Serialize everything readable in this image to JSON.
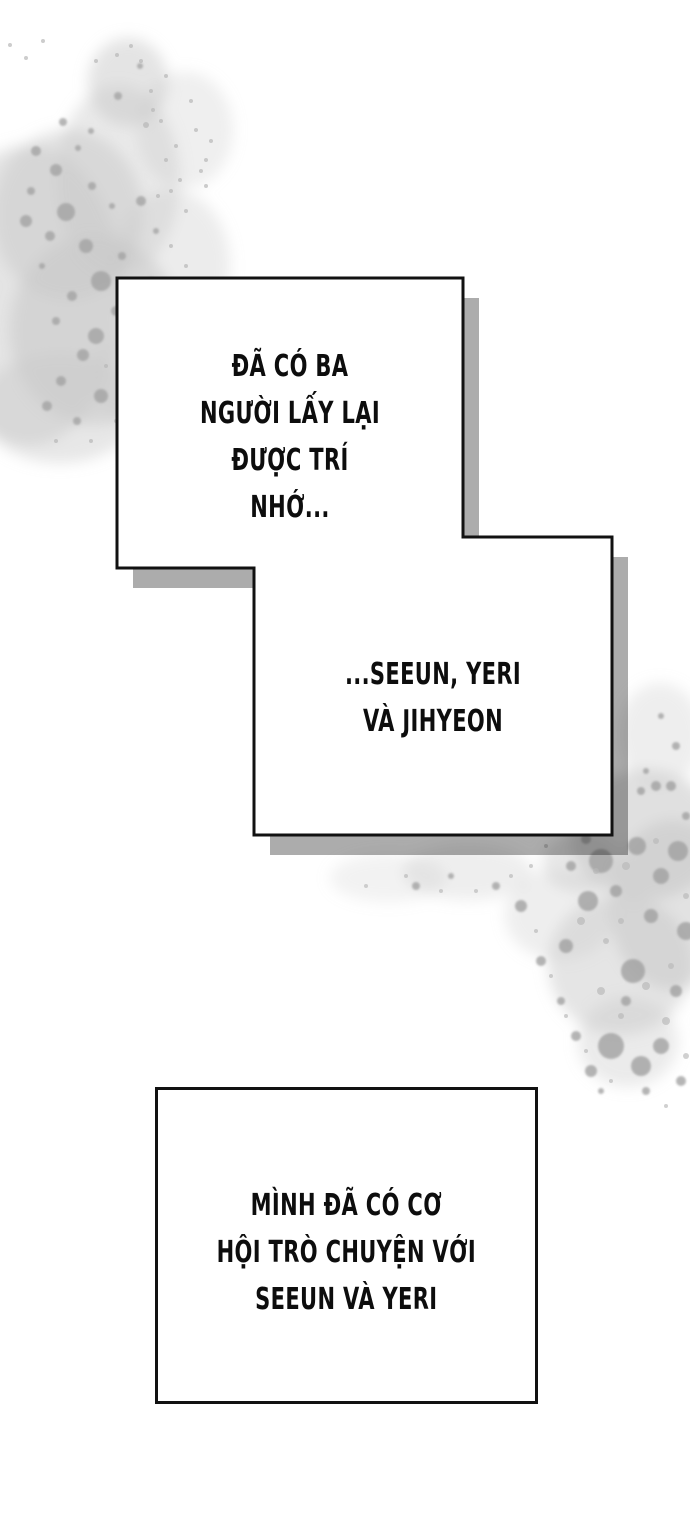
{
  "page": {
    "type": "comic-panel-page",
    "background_color": "#ffffff"
  },
  "colors": {
    "panel_border": "#111111",
    "panel_fill": "#ffffff",
    "panel_shadow": "#acacac",
    "text": "#0d0d0d",
    "watercolor_wash": "#c9c9c9",
    "watercolor_speckle_dark": "#a0a0a0",
    "watercolor_speckle_light": "#b8b8b8"
  },
  "panels": [
    {
      "id": "panel-top",
      "lines": [
        "ĐÃ CÓ BA",
        "NGƯỜI LẤY LẠI",
        "ĐƯỢC TRÍ",
        "NHỚ..."
      ]
    },
    {
      "id": "panel-middle",
      "lines": [
        "...SEEUN, YERI",
        "VÀ JIHYEON"
      ]
    },
    {
      "id": "panel-bottom",
      "lines": [
        "MÌNH ĐÃ CÓ CƠ",
        "HỘI TRÒ CHUYỆN VỚI",
        "SEEUN VÀ YERI"
      ]
    }
  ]
}
